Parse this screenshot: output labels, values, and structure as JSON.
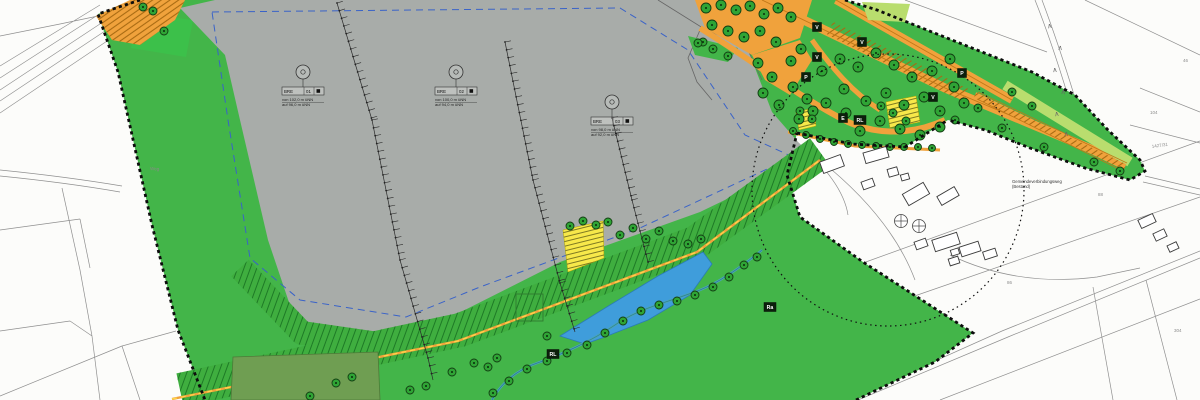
{
  "map_type": "landscape-development-plan-scan",
  "colors": {
    "background": "#fcfcfa",
    "cadastral_line": "#8f8f8f",
    "plan_green": "#43b549",
    "bright_green": "#3cc04a",
    "quarry_gray": "#a8aca9",
    "road_orange": "#f0a23c",
    "road_orange_deep": "#c07818",
    "meadow_lightgreen": "#b9dd6e",
    "measure_yellow": "#f7e84a",
    "pond_blue": "#3f9ddb",
    "quarry_dash_blue": "#3a63c8",
    "stream_teal": "#4aa6b6",
    "forest_olive": "#6f9e52",
    "boundary_black": "#0d0d0d",
    "tree_green": "#2fa435"
  },
  "boundary": {
    "style": "black dashed plan-area boundary",
    "circle_note": "dotted radius circle on right side"
  },
  "bench_labels": [
    {
      "cx": 303,
      "cy": 72,
      "code": [
        "BRE",
        "01"
      ],
      "notes": [
        "von 102,0 m üNN",
        "auf 96,0 m üNN"
      ]
    },
    {
      "cx": 456,
      "cy": 72,
      "code": [
        "BRE",
        "02"
      ],
      "notes": [
        "von 100,0 m üNN",
        "auf 94,0 m üNN"
      ]
    },
    {
      "cx": 612,
      "cy": 102,
      "code": [
        "BRE",
        "03"
      ],
      "notes": [
        "von 98,0 m üNN",
        "auf 92,0 m üNN"
      ]
    }
  ],
  "bench_lines": [
    [
      [
        337,
        3
      ],
      [
        372,
        120
      ],
      [
        400,
        260
      ],
      [
        428,
        358
      ],
      [
        433,
        380
      ]
    ],
    [
      [
        505,
        42
      ],
      [
        533,
        180
      ],
      [
        560,
        283
      ],
      [
        575,
        332
      ]
    ],
    [
      [
        612,
        118
      ],
      [
        632,
        200
      ],
      [
        648,
        262
      ]
    ]
  ],
  "marker_squares": [
    {
      "t": "V",
      "x": 817,
      "y": 27
    },
    {
      "t": "V",
      "x": 862,
      "y": 42
    },
    {
      "t": "V",
      "x": 817,
      "y": 57
    },
    {
      "t": "P",
      "x": 806,
      "y": 77
    },
    {
      "t": "E",
      "x": 843,
      "y": 118
    },
    {
      "t": "RL",
      "x": 860,
      "y": 120
    },
    {
      "t": "V",
      "x": 933,
      "y": 97
    },
    {
      "t": "P",
      "x": 962,
      "y": 73
    },
    {
      "t": "RL",
      "x": 553,
      "y": 354
    },
    {
      "t": "Ra",
      "x": 770,
      "y": 307
    }
  ],
  "parcel_numbers": [
    {
      "t": "104",
      "x": 1150,
      "y": 114,
      "r": 0
    },
    {
      "t": "1427/31",
      "x": 1152,
      "y": 148,
      "r": -8
    },
    {
      "t": "88",
      "x": 1098,
      "y": 196,
      "r": 0
    },
    {
      "t": "86",
      "x": 1007,
      "y": 284,
      "r": 0
    },
    {
      "t": "304",
      "x": 1174,
      "y": 332,
      "r": 0
    },
    {
      "t": "46",
      "x": 1183,
      "y": 62,
      "r": 0
    },
    {
      "t": "Weg",
      "x": 150,
      "y": 170,
      "r": 3
    }
  ],
  "micro_texts": [
    {
      "x": 1012,
      "y": 183,
      "lines": [
        "Gemeindeverbindungsweg",
        "(Bestand)"
      ]
    }
  ],
  "hedge_marks": [
    {
      "x": 1050,
      "y": 28,
      "r": -10
    },
    {
      "x": 1060,
      "y": 50,
      "r": 5
    },
    {
      "x": 1055,
      "y": 72,
      "r": -5
    },
    {
      "x": 1063,
      "y": 94,
      "r": 8
    },
    {
      "x": 1057,
      "y": 116,
      "r": -8
    },
    {
      "x": 1066,
      "y": 136,
      "r": 5
    }
  ],
  "buildings": [
    [
      832,
      164,
      22,
      12,
      -20
    ],
    [
      876,
      155,
      24,
      11,
      -16
    ],
    [
      893,
      172,
      10,
      8,
      -16
    ],
    [
      868,
      184,
      12,
      8,
      -20
    ],
    [
      916,
      194,
      24,
      13,
      -30
    ],
    [
      948,
      196,
      20,
      10,
      -30
    ],
    [
      905,
      177,
      8,
      6,
      -16
    ],
    [
      921,
      244,
      12,
      8,
      -20
    ],
    [
      946,
      242,
      26,
      12,
      -18
    ],
    [
      970,
      249,
      20,
      10,
      -18
    ],
    [
      954,
      261,
      10,
      7,
      -18
    ],
    [
      990,
      254,
      13,
      8,
      -18
    ],
    [
      1147,
      221,
      16,
      9,
      -25
    ],
    [
      1160,
      235,
      12,
      8,
      -25
    ],
    [
      1173,
      247,
      10,
      7,
      -25
    ],
    [
      955,
      252,
      8,
      6,
      -18
    ]
  ],
  "circle_cross_symbols": [
    [
      901,
      221
    ],
    [
      919,
      226
    ]
  ],
  "trees": [
    [
      143,
      7,
      4
    ],
    [
      153,
      11,
      4
    ],
    [
      164,
      31,
      4
    ],
    [
      706,
      8
    ],
    [
      721,
      5
    ],
    [
      736,
      10
    ],
    [
      750,
      6
    ],
    [
      764,
      14
    ],
    [
      778,
      8
    ],
    [
      791,
      17
    ],
    [
      712,
      25
    ],
    [
      728,
      31
    ],
    [
      744,
      37
    ],
    [
      760,
      31
    ],
    [
      776,
      42
    ],
    [
      703,
      42,
      4
    ],
    [
      698,
      43,
      4
    ],
    [
      713,
      49,
      4
    ],
    [
      728,
      56,
      4
    ],
    [
      758,
      63
    ],
    [
      772,
      77
    ],
    [
      763,
      93
    ],
    [
      779,
      105
    ],
    [
      791,
      61
    ],
    [
      801,
      49
    ],
    [
      793,
      87
    ],
    [
      807,
      99
    ],
    [
      799,
      119
    ],
    [
      813,
      111
    ],
    [
      822,
      71
    ],
    [
      840,
      59
    ],
    [
      858,
      67
    ],
    [
      876,
      53
    ],
    [
      894,
      65
    ],
    [
      912,
      77
    ],
    [
      844,
      89
    ],
    [
      826,
      103
    ],
    [
      846,
      113
    ],
    [
      866,
      101
    ],
    [
      886,
      93
    ],
    [
      904,
      105
    ],
    [
      924,
      97
    ],
    [
      940,
      111
    ],
    [
      954,
      87
    ],
    [
      964,
      103
    ],
    [
      932,
      71
    ],
    [
      950,
      59
    ],
    [
      880,
      121
    ],
    [
      860,
      131
    ],
    [
      900,
      129
    ],
    [
      920,
      135
    ],
    [
      940,
      127
    ],
    [
      955,
      120,
      4
    ],
    [
      793,
      131,
      3.5
    ],
    [
      806,
      135,
      3.5
    ],
    [
      820,
      139,
      3.5
    ],
    [
      834,
      142,
      3.5
    ],
    [
      848,
      144,
      3.5
    ],
    [
      862,
      145,
      3.5
    ],
    [
      876,
      146,
      3.5
    ],
    [
      890,
      147,
      3.5
    ],
    [
      904,
      147,
      3.5
    ],
    [
      918,
      147,
      3.5
    ],
    [
      932,
      148,
      3.5
    ],
    [
      978,
      108,
      4
    ],
    [
      1002,
      128,
      4
    ],
    [
      1044,
      147,
      4
    ],
    [
      1094,
      162,
      4
    ],
    [
      1120,
      171,
      4
    ],
    [
      1012,
      92,
      4
    ],
    [
      1032,
      106,
      4
    ],
    [
      570,
      226,
      4
    ],
    [
      583,
      221,
      4
    ],
    [
      596,
      225,
      4
    ],
    [
      608,
      222,
      4
    ],
    [
      620,
      235,
      4
    ],
    [
      633,
      228,
      4
    ],
    [
      646,
      239,
      4
    ],
    [
      659,
      231,
      4
    ],
    [
      673,
      241,
      4
    ],
    [
      688,
      244,
      4
    ],
    [
      701,
      239,
      4
    ],
    [
      800,
      111,
      4
    ],
    [
      812,
      119,
      4
    ],
    [
      893,
      113,
      4
    ],
    [
      906,
      121,
      4
    ],
    [
      881,
      106,
      4
    ],
    [
      757,
      257,
      4
    ],
    [
      744,
      265,
      4
    ],
    [
      729,
      277,
      4
    ],
    [
      713,
      287,
      4
    ],
    [
      695,
      295,
      4
    ],
    [
      677,
      301,
      4
    ],
    [
      659,
      305,
      4
    ],
    [
      641,
      311,
      4
    ],
    [
      623,
      321,
      4
    ],
    [
      605,
      333,
      4
    ],
    [
      587,
      345,
      4
    ],
    [
      567,
      353,
      4
    ],
    [
      547,
      361,
      4
    ],
    [
      527,
      369,
      4
    ],
    [
      509,
      381,
      4
    ],
    [
      493,
      393,
      4
    ],
    [
      410,
      390,
      4
    ],
    [
      426,
      386,
      4
    ],
    [
      452,
      372,
      4
    ],
    [
      474,
      363,
      4
    ],
    [
      488,
      367,
      4
    ],
    [
      497,
      358,
      4
    ],
    [
      547,
      336,
      4
    ],
    [
      352,
      377,
      4
    ],
    [
      336,
      383,
      4
    ],
    [
      310,
      396,
      4
    ]
  ]
}
